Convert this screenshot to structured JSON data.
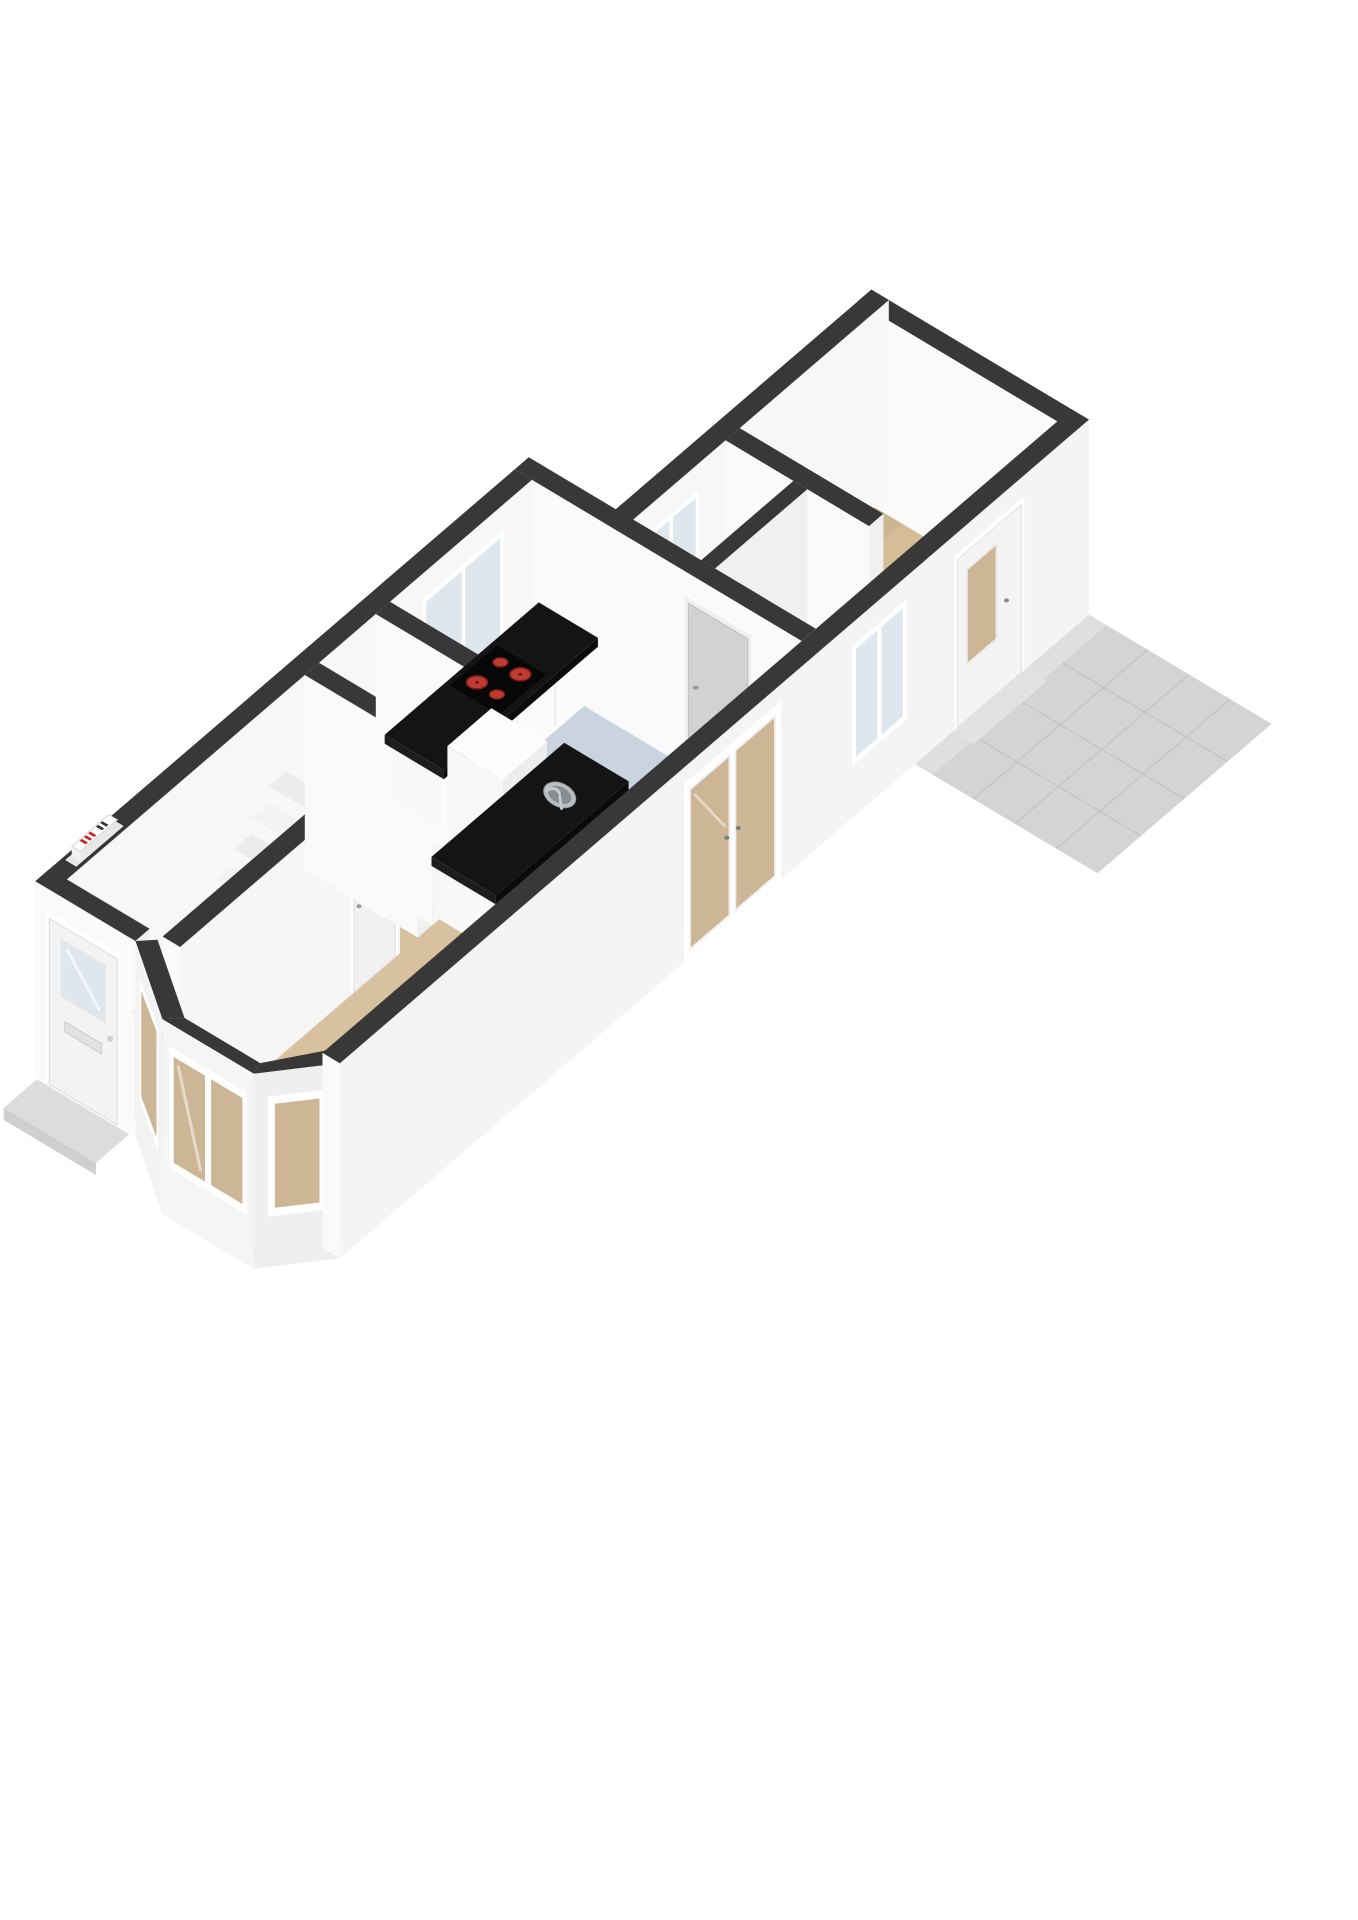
{
  "page": {
    "kind": "3d-floorplan-render",
    "floor": "ground-floor",
    "projection": "isometric",
    "background": "#ffffff"
  },
  "colors": {
    "wall_top": "#383838",
    "face_front": "#fafafa",
    "face_side": "#f0f0f0",
    "face_inner": "#f7f7f7",
    "floor_living": "#d8c19e",
    "floor_kitchen": "#c9d4e0",
    "floor_rear": "#d5bd97",
    "floor_dark": "#161616",
    "floor_wood": "#c49a5f",
    "wood_line": "#ad854e",
    "floor_closet": "#e9e9e9",
    "patio": "#d4d4d4",
    "patio_line": "#c6c6c6",
    "patio_edge": "#dfdfdf",
    "counter_black": "#141414",
    "counter_face": "#1d1d1d",
    "counter_side": "#0b0b0b",
    "hob_red": "#bf3a30",
    "hob_red_dark": "#801d18",
    "glass_warm": "#cdb695",
    "glass_cool": "#dfe7ee",
    "door_white": "#f3f3f3",
    "door_gray": "#d2d2d2",
    "accent_red": "#cc2222",
    "steel": "#b9bec2",
    "steel_dark": "#878d91",
    "step": "#dcdcdc"
  },
  "rooms": [
    {
      "id": "hall",
      "floor_color_key": "floor_wood",
      "features": [
        "front-door",
        "winder-staircase",
        "meter-cupboard"
      ]
    },
    {
      "id": "living-room",
      "floor_color_key": "floor_living",
      "features": [
        "bay-window",
        "understairs-cupboard-door",
        "kitchen-island"
      ]
    },
    {
      "id": "kitchen",
      "floor_color_key": "floor_kitchen",
      "features": [
        "counter-with-cooktop",
        "tall-unit",
        "kitchen-window",
        "french-doors",
        "kitchen-door"
      ]
    },
    {
      "id": "utility-closet",
      "floor_color_key": "floor_closet",
      "features": []
    },
    {
      "id": "rear-hallway",
      "floor_color_key": "floor_dark",
      "features": [
        "side-window",
        "divider-wall"
      ]
    },
    {
      "id": "rear-room",
      "floor_color_key": "floor_rear",
      "features": [
        "back-door"
      ]
    },
    {
      "id": "patio",
      "floor_color_key": "patio",
      "features": [
        "tile-grid",
        "door-threshold"
      ]
    }
  ],
  "fixtures": {
    "cooktop_burners": 4,
    "sinks": 1,
    "bay_window_panes": 4,
    "french_door_leaves": 2
  }
}
